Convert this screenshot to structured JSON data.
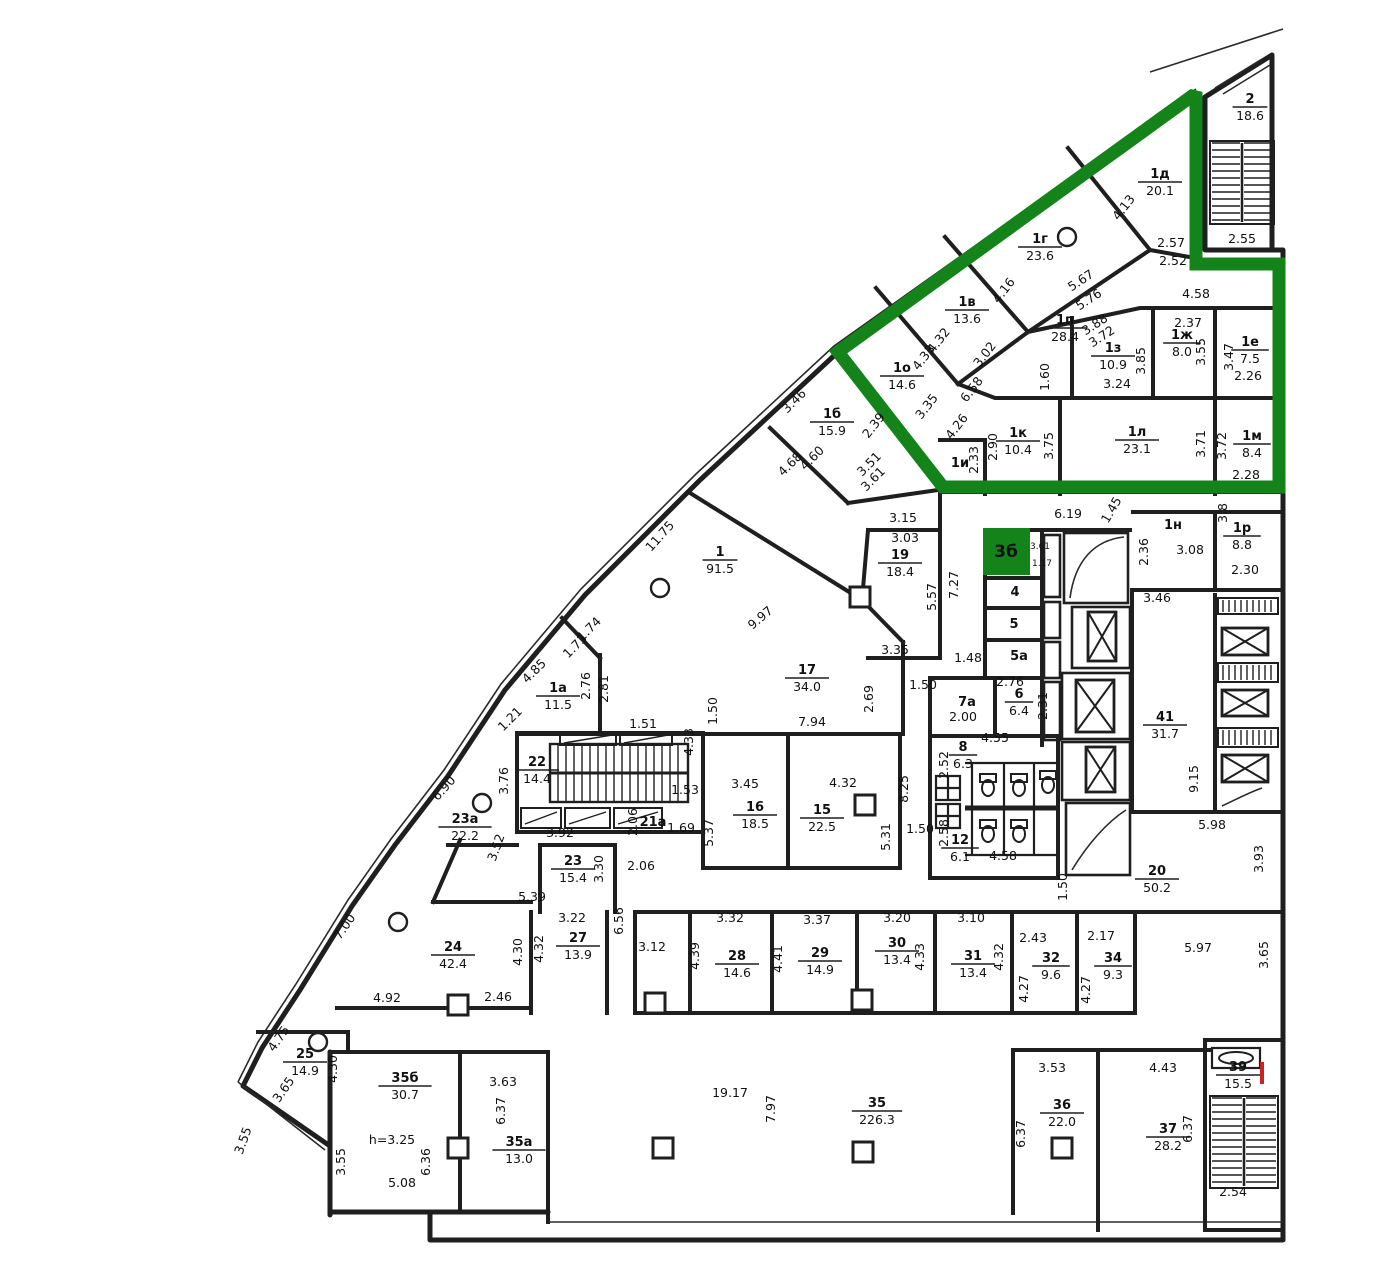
{
  "colors": {
    "wall": "#1f1f1f",
    "green": "#13831a",
    "text": "#111111",
    "red": "#cc2222"
  },
  "marker": {
    "label": "3б"
  },
  "rooms": [
    [
      "2",
      "18.6",
      1250,
      103
    ],
    [
      "1д",
      "20.1",
      1160,
      178
    ],
    [
      "1г",
      "23.6",
      1040,
      243
    ],
    [
      "1в",
      "13.6",
      967,
      306
    ],
    [
      "1п",
      "28.4",
      1065,
      324
    ],
    [
      "1ж",
      "8.0",
      1182,
      339
    ],
    [
      "1е",
      "7.5",
      1250,
      346
    ],
    [
      "1з",
      "10.9",
      1113,
      352
    ],
    [
      "1о",
      "14.6",
      902,
      372
    ],
    [
      "1б",
      "15.9",
      832,
      418
    ],
    [
      "1к",
      "10.4",
      1018,
      437
    ],
    [
      "1л",
      "23.1",
      1137,
      436
    ],
    [
      "1м",
      "8.4",
      1252,
      440
    ],
    [
      "1р",
      "8.8",
      1242,
      532
    ],
    [
      "1",
      "91.5",
      720,
      556
    ],
    [
      "19",
      "18.4",
      900,
      559
    ],
    [
      "17",
      "34.0",
      807,
      674
    ],
    [
      "41",
      "31.7",
      1165,
      721
    ],
    [
      "22",
      "14.4",
      537,
      766
    ],
    [
      "1а",
      "11.5",
      558,
      692
    ],
    [
      "23а",
      "22.2",
      465,
      823
    ],
    [
      "16",
      "18.5",
      755,
      811
    ],
    [
      "15",
      "22.5",
      822,
      814
    ],
    [
      "8",
      "6.3",
      963,
      751
    ],
    [
      "12",
      "6.1",
      960,
      844
    ],
    [
      "6",
      "6.4",
      1019,
      698
    ],
    [
      "23",
      "15.4",
      573,
      865
    ],
    [
      "24",
      "42.4",
      453,
      951
    ],
    [
      "27",
      "13.9",
      578,
      942
    ],
    [
      "25",
      "14.9",
      305,
      1058
    ],
    [
      "28",
      "14.6",
      737,
      960
    ],
    [
      "29",
      "14.9",
      820,
      957
    ],
    [
      "30",
      "13.4",
      897,
      947
    ],
    [
      "31",
      "13.4",
      973,
      960
    ],
    [
      "32",
      "9.6",
      1051,
      962
    ],
    [
      "34",
      "9.3",
      1113,
      962
    ],
    [
      "20",
      "50.2",
      1157,
      875
    ],
    [
      "35б",
      "30.7",
      405,
      1082
    ],
    [
      "35а",
      "13.0",
      519,
      1146
    ],
    [
      "35",
      "226.3",
      877,
      1107
    ],
    [
      "36",
      "22.0",
      1062,
      1109
    ],
    [
      "37",
      "28.2",
      1168,
      1133
    ],
    [
      "39",
      "15.5",
      1238,
      1071
    ]
  ],
  "tags": [
    [
      "4",
      1015,
      596
    ],
    [
      "5",
      1014,
      628
    ],
    [
      "5а",
      1019,
      660
    ],
    [
      "7а",
      967,
      706
    ],
    [
      "21а",
      653,
      826
    ],
    [
      "1н",
      1173,
      529
    ],
    [
      "1и",
      960,
      467
    ]
  ],
  "dims": [
    [
      "4.13",
      1127,
      210,
      -52
    ],
    [
      "2.57",
      1171,
      247,
      0
    ],
    [
      "2.52",
      1173,
      265,
      0
    ],
    [
      "2.55",
      1242,
      243,
      0
    ],
    [
      "5.67",
      1083,
      284,
      -33
    ],
    [
      "5.76",
      1091,
      303,
      -33
    ],
    [
      "4.16",
      1007,
      293,
      -52
    ],
    [
      "3.88",
      1097,
      328,
      -33
    ],
    [
      "3.72",
      1104,
      340,
      -33
    ],
    [
      "4.58",
      1196,
      298,
      0
    ],
    [
      "2.37",
      1188,
      327,
      0
    ],
    [
      "3.02",
      988,
      357,
      -52
    ],
    [
      "4.32",
      942,
      343,
      -52
    ],
    [
      "4.33",
      927,
      360,
      -52
    ],
    [
      "3.55",
      1205,
      352,
      -90
    ],
    [
      "3.47",
      1233,
      357,
      -90
    ],
    [
      "2.26",
      1248,
      380,
      0
    ],
    [
      "3.85",
      1145,
      361,
      -90
    ],
    [
      "3.24",
      1117,
      388,
      0
    ],
    [
      "1.60",
      1049,
      377,
      -90
    ],
    [
      "3.35",
      930,
      409,
      -52
    ],
    [
      "6.58",
      975,
      392,
      -52
    ],
    [
      "4.26",
      960,
      429,
      -52
    ],
    [
      "3.46",
      797,
      404,
      -45
    ],
    [
      "4.60",
      815,
      461,
      -45
    ],
    [
      "4.68",
      793,
      467,
      -45
    ],
    [
      "3.51",
      872,
      467,
      -45
    ],
    [
      "3.61",
      876,
      482,
      -45
    ],
    [
      "2.39",
      877,
      428,
      -52
    ],
    [
      "2.90",
      997,
      447,
      -90
    ],
    [
      "2.33",
      978,
      460,
      -90
    ],
    [
      "3.75",
      1053,
      446,
      -90
    ],
    [
      "3.71",
      1205,
      444,
      -90
    ],
    [
      "3.72",
      1226,
      446,
      -90
    ],
    [
      "2.28",
      1246,
      479,
      0
    ],
    [
      "11.75",
      663,
      539,
      -48
    ],
    [
      "3.15",
      903,
      522,
      0
    ],
    [
      "3.03",
      905,
      542,
      0
    ],
    [
      "5.57",
      936,
      597,
      -90
    ],
    [
      "7.27",
      958,
      585,
      -90
    ],
    [
      "9.97",
      763,
      621,
      -40
    ],
    [
      "3.35",
      895,
      654,
      0
    ],
    [
      "1.48",
      968,
      662,
      0
    ],
    [
      "6.19",
      1068,
      518,
      0
    ],
    [
      "1.45",
      1115,
      512,
      -60
    ],
    [
      "2.36",
      1148,
      552,
      -90
    ],
    [
      "3.08",
      1190,
      554,
      0
    ],
    [
      "2.30",
      1245,
      574,
      0
    ],
    [
      "3.8",
      1227,
      513,
      -90
    ],
    [
      "3.46",
      1157,
      602,
      0
    ],
    [
      "3.61",
      1040,
      549,
      0,
      9
    ],
    [
      "1.17",
      1042,
      566,
      0,
      9
    ],
    [
      "1.74",
      592,
      632,
      -45
    ],
    [
      "1.73",
      578,
      649,
      -45
    ],
    [
      "2.76",
      590,
      686,
      -90
    ],
    [
      "2.81",
      608,
      689,
      -90
    ],
    [
      "4.85",
      537,
      674,
      -45
    ],
    [
      "1.21",
      513,
      722,
      -45
    ],
    [
      "1.51",
      643,
      728,
      0
    ],
    [
      "1.50",
      717,
      711,
      -90
    ],
    [
      "4.33",
      693,
      742,
      -90
    ],
    [
      "7.94",
      812,
      726,
      0
    ],
    [
      "2.69",
      873,
      699,
      -90
    ],
    [
      "1.50",
      923,
      689,
      0
    ],
    [
      "2.00",
      963,
      721,
      0
    ],
    [
      "2.76",
      1010,
      686,
      0
    ],
    [
      "2.31",
      1047,
      706,
      -90
    ],
    [
      "3.76",
      508,
      781,
      -90
    ],
    [
      "6.90",
      447,
      791,
      -48
    ],
    [
      "1.53",
      685,
      794,
      0
    ],
    [
      "2.06",
      637,
      822,
      -90
    ],
    [
      "1.69",
      681,
      832,
      0
    ],
    [
      "3.92",
      560,
      837,
      0
    ],
    [
      "3.52",
      500,
      849,
      -70
    ],
    [
      "3.30",
      603,
      869,
      -90
    ],
    [
      "2.06",
      641,
      870,
      0
    ],
    [
      "5.37",
      713,
      833,
      -90
    ],
    [
      "3.45",
      745,
      788,
      0
    ],
    [
      "4.32",
      843,
      787,
      0
    ],
    [
      "5.31",
      890,
      837,
      -90
    ],
    [
      "8.25",
      908,
      789,
      -90
    ],
    [
      "1.50",
      920,
      833,
      0
    ],
    [
      "4.55",
      995,
      742,
      0
    ],
    [
      "2.52",
      948,
      765,
      -90
    ],
    [
      "2.58",
      948,
      833,
      -90
    ],
    [
      "4.58",
      1003,
      860,
      0
    ],
    [
      "1.50",
      1067,
      887,
      -90
    ],
    [
      "9.15",
      1198,
      779,
      -90
    ],
    [
      "5.98",
      1212,
      829,
      0
    ],
    [
      "3.93",
      1263,
      859,
      -90
    ],
    [
      "5.39",
      532,
      901,
      0
    ],
    [
      "7.00",
      348,
      929,
      -55
    ],
    [
      "3.22",
      572,
      922,
      0
    ],
    [
      "4.30",
      522,
      952,
      -90
    ],
    [
      "4.32",
      543,
      949,
      -90
    ],
    [
      "6.56",
      623,
      921,
      -90
    ],
    [
      "3.12",
      652,
      951,
      0
    ],
    [
      "4.92",
      387,
      1002,
      0
    ],
    [
      "2.46",
      498,
      1001,
      0
    ],
    [
      "4.75",
      282,
      1041,
      -55
    ],
    [
      "4.30",
      337,
      1069,
      -90
    ],
    [
      "3.65",
      287,
      1092,
      -55
    ],
    [
      "3.32",
      730,
      922,
      0
    ],
    [
      "4.39",
      699,
      956,
      -90
    ],
    [
      "3.37",
      817,
      924,
      0
    ],
    [
      "4.41",
      782,
      959,
      -90
    ],
    [
      "3.20",
      897,
      922,
      0
    ],
    [
      "4.33",
      924,
      957,
      -90
    ],
    [
      "3.10",
      971,
      922,
      0
    ],
    [
      "4.32",
      1003,
      957,
      -90
    ],
    [
      "2.43",
      1033,
      942,
      0
    ],
    [
      "4.27",
      1028,
      989,
      -90
    ],
    [
      "2.17",
      1101,
      940,
      0
    ],
    [
      "4.27",
      1090,
      990,
      -90
    ],
    [
      "5.97",
      1198,
      952,
      0
    ],
    [
      "3.65",
      1268,
      955,
      -90
    ],
    [
      "19.17",
      730,
      1097,
      0
    ],
    [
      "7.97",
      775,
      1109,
      -90
    ],
    [
      "h=3.25",
      392,
      1144,
      0
    ],
    [
      "5.08",
      402,
      1187,
      0
    ],
    [
      "3.55",
      345,
      1162,
      -90
    ],
    [
      "6.36",
      430,
      1162,
      -90
    ],
    [
      "3.55",
      247,
      1142,
      -70
    ],
    [
      "3.63",
      503,
      1086,
      0
    ],
    [
      "6.37",
      505,
      1111,
      -90
    ],
    [
      "3.53",
      1052,
      1072,
      0
    ],
    [
      "6.37",
      1025,
      1134,
      -90
    ],
    [
      "4.43",
      1163,
      1072,
      0
    ],
    [
      "6.37",
      1192,
      1129,
      -90
    ],
    [
      "2.54",
      1233,
      1196,
      0
    ]
  ]
}
